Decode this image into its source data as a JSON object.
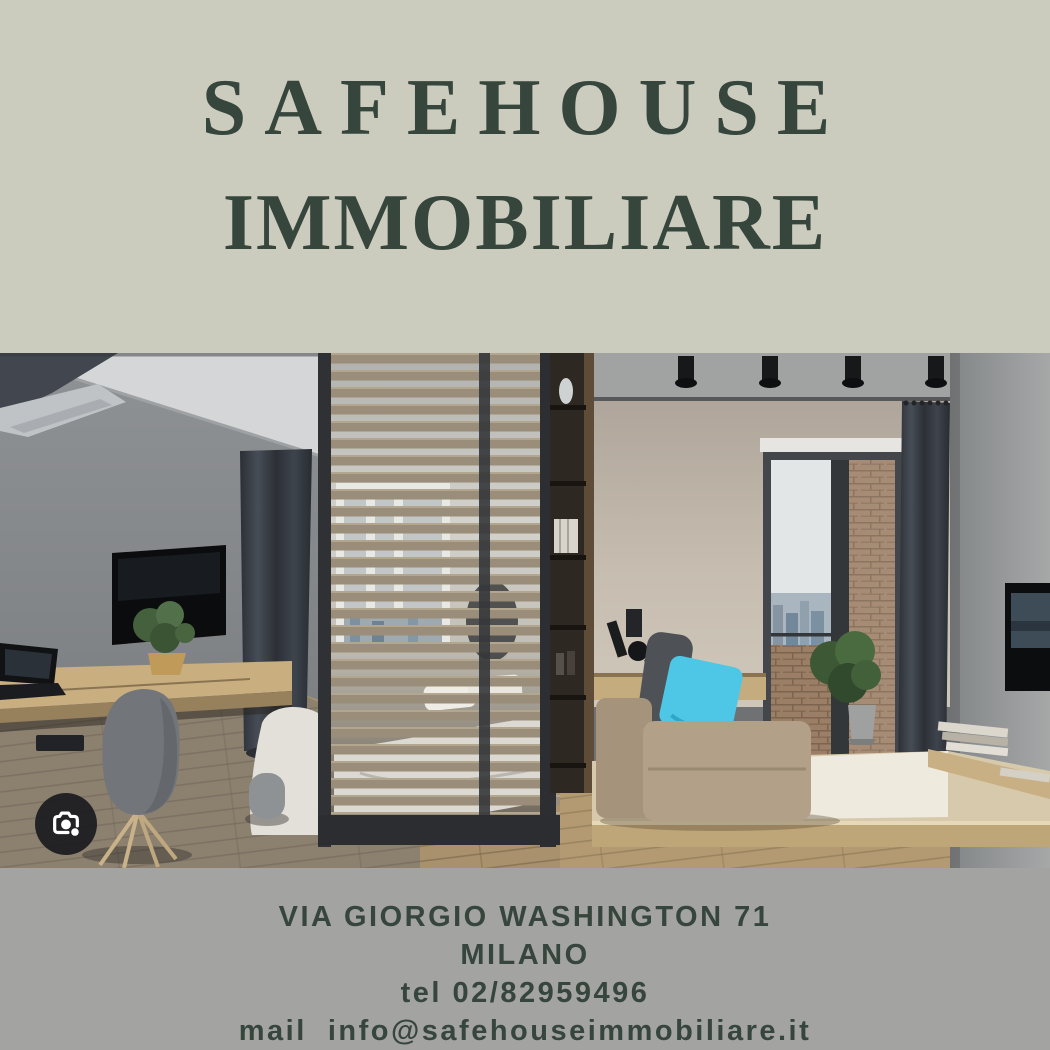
{
  "brand": {
    "title_line1": "SAFEHOUSE",
    "title_line2": "IMMOBILIARE"
  },
  "contact": {
    "address": "VIA GIORGIO WASHINGTON 71",
    "city": "MILANO",
    "phone": "tel 02/82959496",
    "email": "mail  info@safehouseimmobiliare.it"
  },
  "photo": {
    "description": "Modern studio apartment interior: gray wall with TV and wooden desk, wood slat partition with bed behind it, beige daybed with turquoise pillow, balcony door with brick wall and plant, dark curtains",
    "lens_icon": "google-lens-camera-icon"
  },
  "colors": {
    "header-bg": "#cbccbe",
    "brand-green": "#36463d",
    "footer-bg": "#a3a3a2",
    "accent-cyan": "#4ec7e6"
  }
}
